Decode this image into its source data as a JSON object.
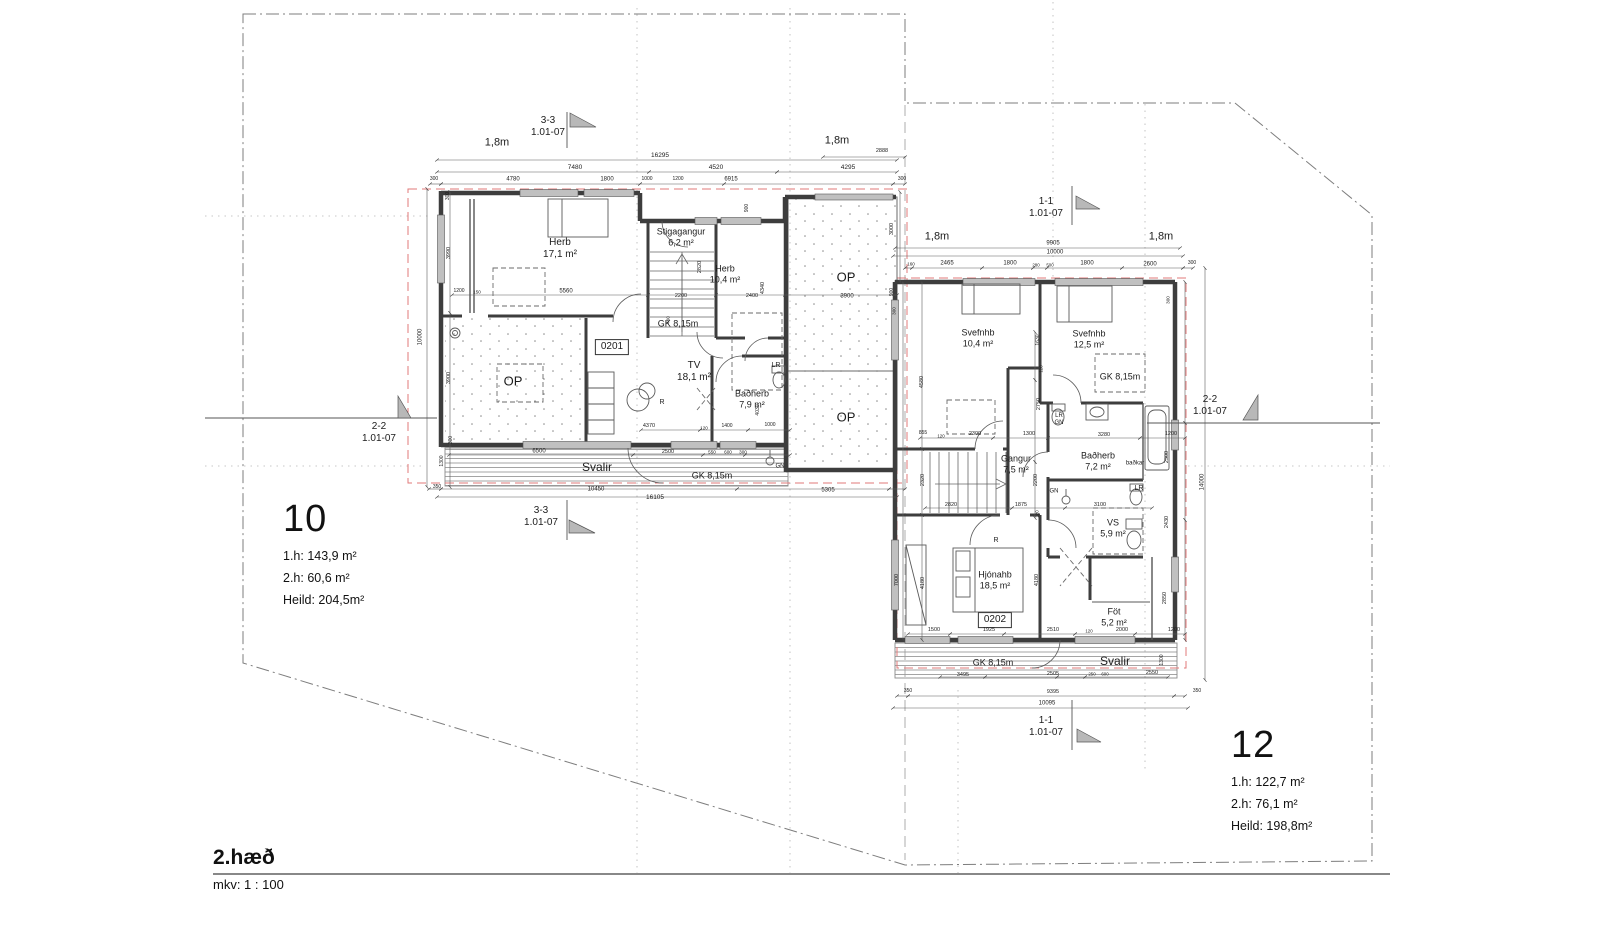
{
  "page": {
    "floor_title": "2.hæð",
    "scale_label": "mkv: 1 : 100"
  },
  "colors": {
    "wall": "#3d3d3d",
    "dim": "#555555",
    "roof_dash": "#e07a7a",
    "deck": "#9a9a9a",
    "flag": "#b8b8b8"
  },
  "units": [
    {
      "number": "10",
      "area_lines": [
        "1.h: 143,9 m²",
        "2.h: 60,6 m²",
        "Heild: 204,5m²"
      ]
    },
    {
      "number": "12",
      "area_lines": [
        "1.h: 122,7 m²",
        "2.h: 76,1 m²",
        "Heild: 198,8m²"
      ]
    }
  ],
  "labels": [
    {
      "n": "section-3-3-top",
      "t": "3-3\n1.01-07",
      "x": 548,
      "y": 127,
      "s": 10
    },
    {
      "n": "section-3-3-bottom",
      "t": "3-3\n1.01-07",
      "x": 541,
      "y": 517,
      "s": 10
    },
    {
      "n": "section-1-1-top",
      "t": "1-1\n1.01-07",
      "x": 1046,
      "y": 208,
      "s": 10
    },
    {
      "n": "section-1-1-bottom",
      "t": "1-1\n1.01-07",
      "x": 1046,
      "y": 727,
      "s": 10
    },
    {
      "n": "section-2-2-left",
      "t": "2-2\n1.01-07",
      "x": 379,
      "y": 433,
      "s": 10
    },
    {
      "n": "section-2-2-right",
      "t": "2-2\n1.01-07",
      "x": 1210,
      "y": 406,
      "s": 10
    },
    {
      "n": "setback-1",
      "t": "1,8m",
      "x": 497,
      "y": 143,
      "s": 11
    },
    {
      "n": "setback-2",
      "t": "1,8m",
      "x": 837,
      "y": 141,
      "s": 11
    },
    {
      "n": "setback-3",
      "t": "1,8m",
      "x": 937,
      "y": 237,
      "s": 11
    },
    {
      "n": "setback-4",
      "t": "1,8m",
      "x": 1161,
      "y": 237,
      "s": 11
    },
    {
      "n": "room-herb-17",
      "t": "Herb\n17,1 m²",
      "x": 560,
      "y": 249,
      "s": 10
    },
    {
      "n": "room-stigagangur",
      "t": "Stigagangur\n6,2 m²",
      "x": 681,
      "y": 237,
      "s": 9
    },
    {
      "n": "room-herb-10",
      "t": "Herb\n10,4 m²",
      "x": 725,
      "y": 274,
      "s": 9
    },
    {
      "n": "gk-815-1",
      "t": "GK 8,15m",
      "x": 678,
      "y": 324,
      "s": 9
    },
    {
      "n": "room-id-0201",
      "t": "0201",
      "x": 612,
      "y": 347,
      "s": 10,
      "bx": true
    },
    {
      "n": "room-tv",
      "t": "TV\n18,1 m²",
      "x": 694,
      "y": 372,
      "s": 10
    },
    {
      "n": "op-1",
      "t": "OP",
      "x": 513,
      "y": 381,
      "s": 13
    },
    {
      "n": "op-2",
      "t": "OP",
      "x": 846,
      "y": 277,
      "s": 13
    },
    {
      "n": "op-3",
      "t": "OP",
      "x": 846,
      "y": 417,
      "s": 13
    },
    {
      "n": "room-badherb-79",
      "t": "Baðherb\n7,9 m²",
      "x": 752,
      "y": 399,
      "s": 9
    },
    {
      "n": "fixture-lr-1",
      "t": "LR",
      "x": 776,
      "y": 366,
      "s": 7
    },
    {
      "n": "marker-r-1",
      "t": "R",
      "x": 662,
      "y": 403,
      "s": 7
    },
    {
      "n": "room-svalir-1",
      "t": "Svalir",
      "x": 597,
      "y": 467,
      "s": 12
    },
    {
      "n": "gk-815-2",
      "t": "GK 8,15m",
      "x": 712,
      "y": 476,
      "s": 9
    },
    {
      "n": "marker-gn-1",
      "t": "GN",
      "x": 780,
      "y": 467,
      "s": 6
    },
    {
      "n": "room-svefnhb-104",
      "t": "Svefnhb\n10,4 m²",
      "x": 978,
      "y": 338,
      "s": 9
    },
    {
      "n": "room-svefnhb-125",
      "t": "Svefnhb\n12,5 m²",
      "x": 1089,
      "y": 339,
      "s": 9
    },
    {
      "n": "gk-815-3",
      "t": "GK 8,15m",
      "x": 1120,
      "y": 377,
      "s": 9
    },
    {
      "n": "fixture-lr-gn",
      "t": "LR\nGN",
      "x": 1059,
      "y": 420,
      "s": 6
    },
    {
      "n": "room-gangur",
      "t": "Gangur\n7,5 m²",
      "x": 1016,
      "y": 464,
      "s": 9
    },
    {
      "n": "room-badherb-72",
      "t": "Baðherb\n7,2 m²",
      "x": 1098,
      "y": 461,
      "s": 9
    },
    {
      "n": "fixture-badkar",
      "t": "baðkar",
      "x": 1135,
      "y": 464,
      "s": 6
    },
    {
      "n": "marker-gn-2",
      "t": "GN",
      "x": 1054,
      "y": 492,
      "s": 6
    },
    {
      "n": "fixture-lr-2",
      "t": "LR",
      "x": 1139,
      "y": 489,
      "s": 7
    },
    {
      "n": "room-vs",
      "t": "VS\n5,9 m²",
      "x": 1113,
      "y": 528,
      "s": 9
    },
    {
      "n": "marker-r-2",
      "t": "R",
      "x": 996,
      "y": 541,
      "s": 7
    },
    {
      "n": "room-hjonahb",
      "t": "Hjónahb\n18,5 m²",
      "x": 995,
      "y": 580,
      "s": 9
    },
    {
      "n": "room-id-0202",
      "t": "0202",
      "x": 995,
      "y": 620,
      "s": 10,
      "bx": true
    },
    {
      "n": "room-fot",
      "t": "Föt\n5,2 m²",
      "x": 1114,
      "y": 617,
      "s": 9
    },
    {
      "n": "gk-815-4",
      "t": "GK 8,15m",
      "x": 993,
      "y": 663,
      "s": 9
    },
    {
      "n": "room-svalir-2",
      "t": "Svalir",
      "x": 1115,
      "y": 661,
      "s": 12
    },
    {
      "n": "dim",
      "t": "16295",
      "x": 660,
      "y": 156,
      "s": 6.5
    },
    {
      "n": "dim",
      "t": "7480",
      "x": 575,
      "y": 168,
      "s": 6.5
    },
    {
      "n": "dim",
      "t": "4520",
      "x": 716,
      "y": 168,
      "s": 6.5
    },
    {
      "n": "dim",
      "t": "4295",
      "x": 848,
      "y": 168,
      "s": 6.5
    },
    {
      "n": "dim",
      "t": "2888",
      "x": 882,
      "y": 151,
      "s": 5.5
    },
    {
      "n": "dim",
      "t": "300",
      "x": 434,
      "y": 180,
      "s": 5
    },
    {
      "n": "dim",
      "t": "4780",
      "x": 513,
      "y": 180,
      "s": 6
    },
    {
      "n": "dim",
      "t": "1800",
      "x": 607,
      "y": 180,
      "s": 6
    },
    {
      "n": "dim",
      "t": "1000",
      "x": 647,
      "y": 180,
      "s": 5
    },
    {
      "n": "dim",
      "t": "1200",
      "x": 678,
      "y": 180,
      "s": 5
    },
    {
      "n": "dim",
      "t": "6915",
      "x": 731,
      "y": 180,
      "s": 6
    },
    {
      "n": "dim",
      "t": "300",
      "x": 902,
      "y": 180,
      "s": 5
    },
    {
      "n": "dim",
      "t": "300",
      "x": 449,
      "y": 196,
      "s": 5,
      "r": -90
    },
    {
      "n": "dim",
      "t": "3990",
      "x": 449,
      "y": 253,
      "s": 5.5,
      "r": -90
    },
    {
      "n": "dim",
      "t": "10000",
      "x": 421,
      "y": 337,
      "s": 6,
      "r": -90
    },
    {
      "n": "dim",
      "t": "3900",
      "x": 449,
      "y": 378,
      "s": 5.5,
      "r": -90
    },
    {
      "n": "dim",
      "t": "300",
      "x": 452,
      "y": 440,
      "s": 5,
      "r": -90
    },
    {
      "n": "dim",
      "t": "1300",
      "x": 443,
      "y": 461,
      "s": 5,
      "r": -90
    },
    {
      "n": "dim",
      "t": "350",
      "x": 437,
      "y": 488,
      "s": 5
    },
    {
      "n": "dim",
      "t": "1200",
      "x": 459,
      "y": 292,
      "s": 5
    },
    {
      "n": "dim",
      "t": "150",
      "x": 477,
      "y": 292,
      "s": 4.6
    },
    {
      "n": "dim",
      "t": "5560",
      "x": 566,
      "y": 292,
      "s": 6
    },
    {
      "n": "dim",
      "t": "2200",
      "x": 681,
      "y": 296,
      "s": 5.5
    },
    {
      "n": "dim",
      "t": "2400",
      "x": 752,
      "y": 296,
      "s": 5.5
    },
    {
      "n": "dim",
      "t": "2820",
      "x": 700,
      "y": 267,
      "s": 5.5,
      "r": -90
    },
    {
      "n": "dim",
      "t": "4340",
      "x": 763,
      "y": 288,
      "s": 5.5,
      "r": -90
    },
    {
      "n": "dim",
      "t": "900",
      "x": 748,
      "y": 208,
      "s": 5,
      "r": -90
    },
    {
      "n": "dim",
      "t": "460",
      "x": 668,
      "y": 320,
      "s": 4.6,
      "r": -90
    },
    {
      "n": "dim",
      "t": "3900",
      "x": 847,
      "y": 297,
      "s": 6
    },
    {
      "n": "dim",
      "t": "4370",
      "x": 649,
      "y": 426,
      "s": 5.5
    },
    {
      "n": "dim",
      "t": "120",
      "x": 704,
      "y": 428,
      "s": 4.6
    },
    {
      "n": "dim",
      "t": "1400",
      "x": 727,
      "y": 427,
      "s": 5
    },
    {
      "n": "dim",
      "t": "1000",
      "x": 770,
      "y": 426,
      "s": 5
    },
    {
      "n": "dim",
      "t": "4030",
      "x": 759,
      "y": 410,
      "s": 5,
      "r": -90
    },
    {
      "n": "dim",
      "t": "6500",
      "x": 539,
      "y": 452,
      "s": 6
    },
    {
      "n": "dim",
      "t": "2500",
      "x": 668,
      "y": 452,
      "s": 5.5
    },
    {
      "n": "dim",
      "t": "550",
      "x": 712,
      "y": 452,
      "s": 4.6
    },
    {
      "n": "dim",
      "t": "600",
      "x": 728,
      "y": 452,
      "s": 4.6
    },
    {
      "n": "dim",
      "t": "300",
      "x": 743,
      "y": 452,
      "s": 4.6
    },
    {
      "n": "dim",
      "t": "10450",
      "x": 596,
      "y": 490,
      "s": 6
    },
    {
      "n": "dim",
      "t": "5305",
      "x": 828,
      "y": 491,
      "s": 6
    },
    {
      "n": "dim",
      "t": "16105",
      "x": 655,
      "y": 498,
      "s": 6.5
    },
    {
      "n": "dim",
      "t": "9905",
      "x": 1053,
      "y": 244,
      "s": 6
    },
    {
      "n": "dim",
      "t": "10000",
      "x": 1055,
      "y": 253,
      "s": 6
    },
    {
      "n": "dim",
      "t": "160",
      "x": 911,
      "y": 264,
      "s": 4.6
    },
    {
      "n": "dim",
      "t": "2465",
      "x": 947,
      "y": 264,
      "s": 6
    },
    {
      "n": "dim",
      "t": "1800",
      "x": 1010,
      "y": 264,
      "s": 6
    },
    {
      "n": "dim",
      "t": "280",
      "x": 1036,
      "y": 265,
      "s": 4.4
    },
    {
      "n": "dim",
      "t": "500",
      "x": 1050,
      "y": 265,
      "s": 4.4
    },
    {
      "n": "dim",
      "t": "1800",
      "x": 1087,
      "y": 264,
      "s": 6
    },
    {
      "n": "dim",
      "t": "2600",
      "x": 1150,
      "y": 265,
      "s": 6
    },
    {
      "n": "dim",
      "t": "300",
      "x": 1192,
      "y": 264,
      "s": 5
    },
    {
      "n": "dim",
      "t": "3000",
      "x": 892,
      "y": 229,
      "s": 5.5,
      "r": -90
    },
    {
      "n": "dim",
      "t": "900",
      "x": 893,
      "y": 292,
      "s": 5,
      "r": -90
    },
    {
      "n": "dim",
      "t": "300",
      "x": 894,
      "y": 311,
      "s": 4.6,
      "r": -90
    },
    {
      "n": "dim",
      "t": "4580",
      "x": 922,
      "y": 382,
      "s": 5.5,
      "r": -90
    },
    {
      "n": "dim",
      "t": "2320",
      "x": 923,
      "y": 480,
      "s": 5.5,
      "r": -90
    },
    {
      "n": "dim",
      "t": "7000",
      "x": 897,
      "y": 580,
      "s": 5.5,
      "r": -90
    },
    {
      "n": "dim",
      "t": "4180",
      "x": 923,
      "y": 583,
      "s": 5.5,
      "r": -90
    },
    {
      "n": "dim",
      "t": "4180",
      "x": 1037,
      "y": 580,
      "s": 5.5,
      "r": -90
    },
    {
      "n": "dim",
      "t": "855",
      "x": 923,
      "y": 434,
      "s": 5
    },
    {
      "n": "dim",
      "t": "120",
      "x": 941,
      "y": 436,
      "s": 4.4
    },
    {
      "n": "dim",
      "t": "2300",
      "x": 975,
      "y": 434,
      "s": 5.5
    },
    {
      "n": "dim",
      "t": "1300",
      "x": 1029,
      "y": 434,
      "s": 5.5
    },
    {
      "n": "dim",
      "t": "3280",
      "x": 1104,
      "y": 435,
      "s": 5.5
    },
    {
      "n": "dim",
      "t": "1200",
      "x": 1171,
      "y": 434,
      "s": 5.5
    },
    {
      "n": "dim",
      "t": "1630",
      "x": 1039,
      "y": 340,
      "s": 5,
      "r": -90
    },
    {
      "n": "dim",
      "t": "120",
      "x": 1041,
      "y": 369,
      "s": 4.4,
      "r": -90
    },
    {
      "n": "dim",
      "t": "2750",
      "x": 1039,
      "y": 404,
      "s": 5.5,
      "r": -90
    },
    {
      "n": "dim",
      "t": "2200",
      "x": 1036,
      "y": 480,
      "s": 5.5,
      "r": -90
    },
    {
      "n": "dim",
      "t": "120",
      "x": 1037,
      "y": 514,
      "s": 4.4,
      "r": -90
    },
    {
      "n": "dim",
      "t": "2820",
      "x": 951,
      "y": 505,
      "s": 5.5
    },
    {
      "n": "dim",
      "t": "1875",
      "x": 1021,
      "y": 505,
      "s": 5.5
    },
    {
      "n": "dim",
      "t": "3100",
      "x": 1100,
      "y": 505,
      "s": 5.5
    },
    {
      "n": "dim",
      "t": "300",
      "x": 1168,
      "y": 300,
      "s": 4.6,
      "r": -90
    },
    {
      "n": "dim",
      "t": "2300",
      "x": 1167,
      "y": 457,
      "s": 5.5,
      "r": -90
    },
    {
      "n": "dim",
      "t": "2430",
      "x": 1167,
      "y": 522,
      "s": 5.5,
      "r": -90
    },
    {
      "n": "dim",
      "t": "2850",
      "x": 1165,
      "y": 598,
      "s": 5.5,
      "r": -90
    },
    {
      "n": "dim",
      "t": "14000",
      "x": 1203,
      "y": 482,
      "s": 6,
      "r": -90
    },
    {
      "n": "dim",
      "t": "1500",
      "x": 934,
      "y": 630,
      "s": 5.5
    },
    {
      "n": "dim",
      "t": "1925",
      "x": 989,
      "y": 630,
      "s": 5.5
    },
    {
      "n": "dim",
      "t": "2510",
      "x": 1053,
      "y": 630,
      "s": 5.5
    },
    {
      "n": "dim",
      "t": "120",
      "x": 1089,
      "y": 631,
      "s": 4.4
    },
    {
      "n": "dim",
      "t": "2000",
      "x": 1122,
      "y": 630,
      "s": 5.5
    },
    {
      "n": "dim",
      "t": "1200",
      "x": 1174,
      "y": 630,
      "s": 5.5
    },
    {
      "n": "dim",
      "t": "3495",
      "x": 963,
      "y": 675,
      "s": 5.5
    },
    {
      "n": "dim",
      "t": "2505",
      "x": 1053,
      "y": 674,
      "s": 5.5
    },
    {
      "n": "dim",
      "t": "250",
      "x": 1092,
      "y": 674,
      "s": 4.4
    },
    {
      "n": "dim",
      "t": "600",
      "x": 1105,
      "y": 674,
      "s": 4.4
    },
    {
      "n": "dim",
      "t": "2550",
      "x": 1152,
      "y": 673,
      "s": 5.5
    },
    {
      "n": "dim",
      "t": "1300",
      "x": 1163,
      "y": 660,
      "s": 5,
      "r": -90
    },
    {
      "n": "dim",
      "t": "9395",
      "x": 1053,
      "y": 692,
      "s": 5.5
    },
    {
      "n": "dim",
      "t": "350",
      "x": 908,
      "y": 692,
      "s": 5
    },
    {
      "n": "dim",
      "t": "350",
      "x": 1197,
      "y": 692,
      "s": 5
    },
    {
      "n": "dim",
      "t": "10095",
      "x": 1047,
      "y": 704,
      "s": 6
    }
  ]
}
